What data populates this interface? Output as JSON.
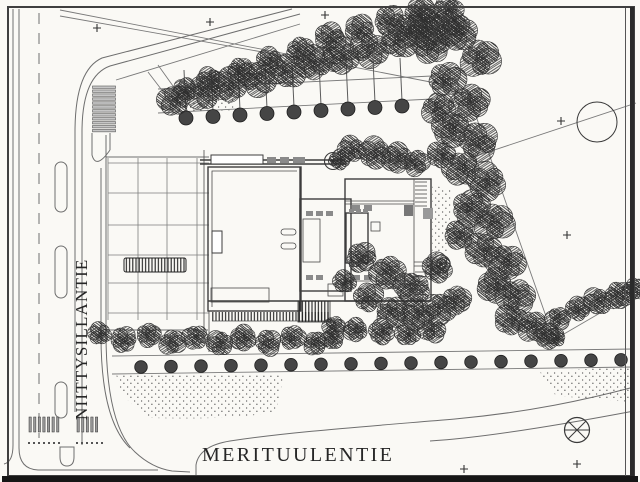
{
  "document": {
    "kind": "scanned architectural site plan",
    "paper_color": "#faf9f5",
    "ink_color": "#3d3d3d",
    "road_line_color": "#6e6e6e"
  },
  "streets": {
    "west": {
      "name": "NIITTYSILLANTIE",
      "orientation": "vertical-left"
    },
    "south": {
      "name": "MERITUULENTIE",
      "orientation": "horizontal-bottom"
    }
  },
  "site": {
    "features": {
      "parking_row_trees": 9,
      "hedge_row_bushes": 17,
      "crosswalk_bars_north": 12,
      "zebra_bars_west_group": 7,
      "zebra_bars_east_group": 5,
      "plus_survey_marks": 7,
      "flagpole_circles": 2
    }
  },
  "symbols": {
    "survey_target": "circle-with-cross benchmark",
    "boundary_circle": "open circle on boundary line",
    "median_islands": 4
  }
}
